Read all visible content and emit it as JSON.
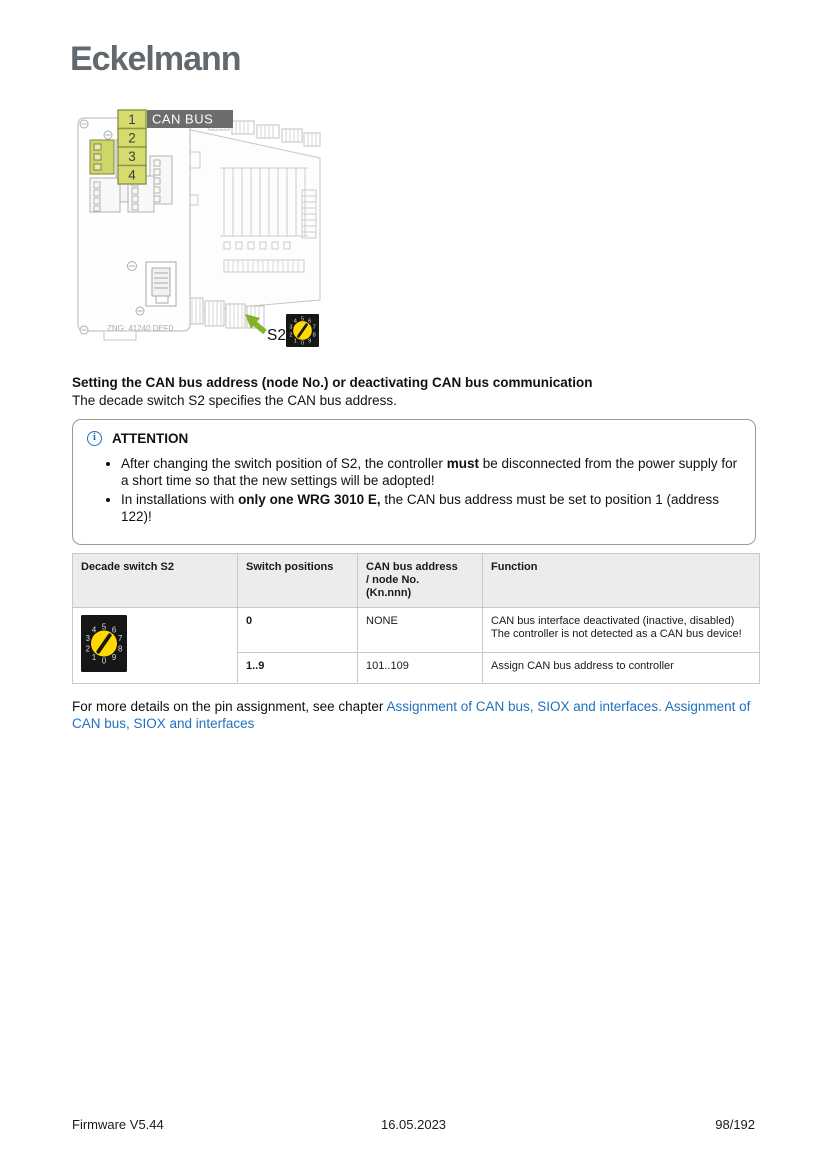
{
  "logo": "Eckelmann",
  "figure": {
    "callouts": [
      "1",
      "2",
      "3",
      "4"
    ],
    "can_bus_label": "CAN BUS",
    "board_text": "ZNG: 41240 DEF0",
    "s2_label": "S2",
    "dial": {
      "digits": [
        "0",
        "1",
        "2",
        "3",
        "4",
        "5",
        "6",
        "7",
        "8",
        "9"
      ],
      "needle_angle_deg": 35,
      "colors": {
        "body": "#161616",
        "dial": "#ffd900",
        "digits": "#dcdcdc",
        "needle": "#161616"
      }
    },
    "colors": {
      "highlight": "#cdd669",
      "callout_fill": "#d6db6e",
      "callout_stroke": "#8d9447",
      "label_bg": "#6d6d6d",
      "arrow_green": "#84b32a"
    }
  },
  "section": {
    "heading": "Setting the CAN bus address (node No.) or deactivating CAN bus communication",
    "intro": "The decade switch S2 specifies the CAN bus address."
  },
  "attention": {
    "icon_glyph": "i",
    "title": "ATTENTION",
    "bullets": [
      {
        "pre": "After changing the switch position of S2, the controller ",
        "bold": "must",
        "post": " be disconnected from the power supply for a short time so that the new settings will be adopted!"
      },
      {
        "pre": "In installations with ",
        "bold": "only one WRG 3010 E,",
        "post": " the CAN bus address must be set to position 1 (address 122)!"
      }
    ]
  },
  "table": {
    "headers": [
      "Decade switch S2",
      "Switch positions",
      "CAN bus address\n/ node No.\n(Kn.nnn)",
      "Function"
    ],
    "rows": [
      {
        "positions": "0",
        "address": "NONE",
        "function": "CAN bus interface deactivated (inactive, disabled)\nThe controller is not detected as a CAN bus device!"
      },
      {
        "positions": "1..9",
        "address": "101..109",
        "function": "Assign CAN bus address to controller"
      }
    ]
  },
  "links_paragraph": {
    "pre": "For more details on the pin assignment, see chapter ",
    "link1": "Assignment of CAN bus, SIOX and interfaces.",
    "separator": " ",
    "link2": "Assignment of CAN bus, SIOX and interfaces"
  },
  "footer": {
    "left": "Firmware V5.44",
    "center": "16.05.2023",
    "right": "98/192"
  }
}
